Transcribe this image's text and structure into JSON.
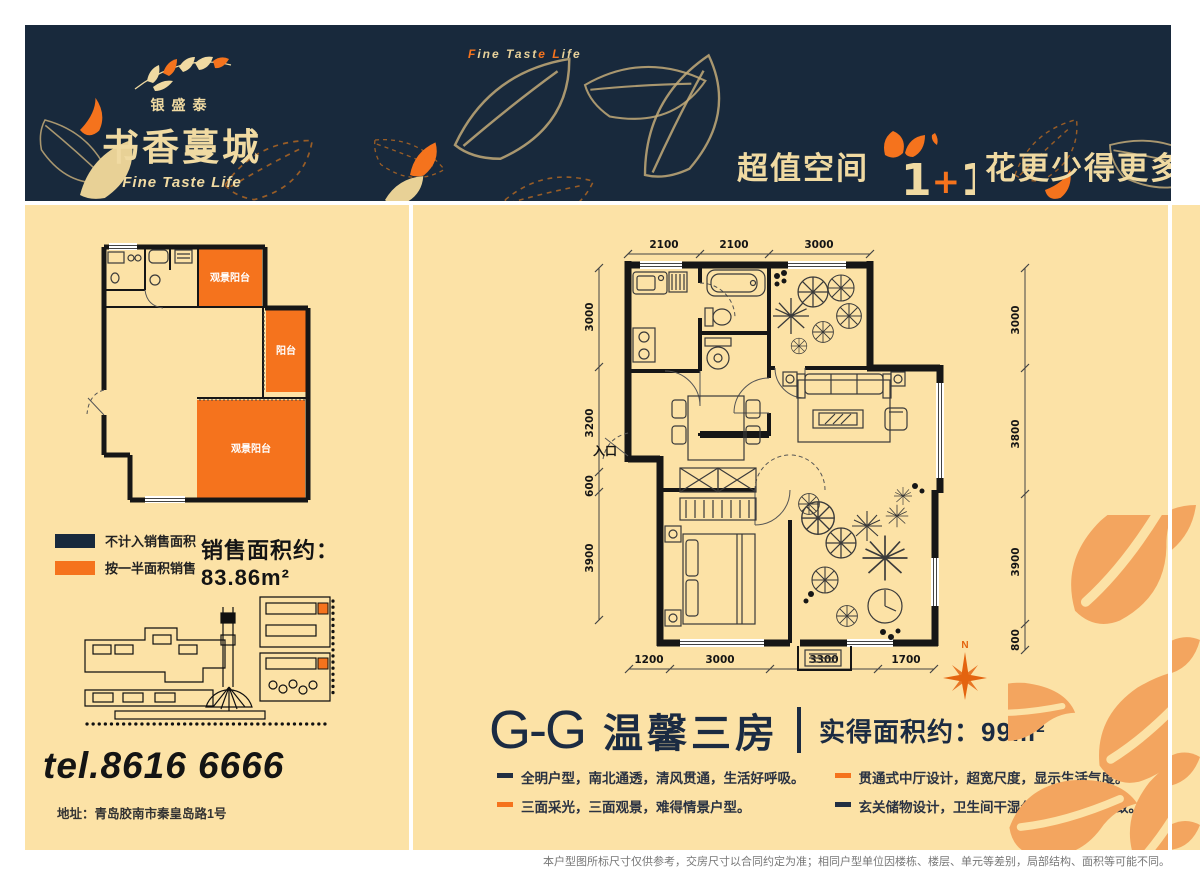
{
  "colors": {
    "navy": "#18293C",
    "cream": "#FCE2A6",
    "beige_text": "#F0DAA2",
    "orange": "#F5731D",
    "leaf_orange": "#F3A55F",
    "ink": "#161616"
  },
  "header": {
    "brand_small": "银盛泰",
    "brand_main": "书香蔓城",
    "brand_sub": "Fine Taste Life",
    "tagline_parts": [
      "F",
      "ine ",
      "Tast",
      "e ",
      "L",
      "ife"
    ],
    "promo_left": "超值空间",
    "promo_mark_parts": [
      "1",
      "+",
      "1"
    ],
    "promo_right": "花更少得更多"
  },
  "left_panel": {
    "plan_labels": {
      "balcony_top": "观景阳台",
      "balcony_side": "阳台",
      "balcony_bottom": "观景阳台"
    },
    "legend": [
      {
        "label": "不计入销售面积",
        "color": "#18293C"
      },
      {
        "label": "按一半面积销售",
        "color": "#F5731D"
      }
    ],
    "sales_area": "销售面积约：83.86m²",
    "tel": "tel.8616 6666",
    "address": "地址：青岛胶南市秦皇岛路1号"
  },
  "right_panel": {
    "plan": {
      "entrance_label": "入口",
      "compass_label": "N",
      "dims_top": [
        "2100",
        "2100",
        "3000"
      ],
      "dims_left": [
        "3000",
        "3200",
        "600",
        "3900"
      ],
      "dims_right": [
        "3000",
        "3800",
        "3900",
        "800"
      ],
      "dims_bottom": [
        "1200",
        "3000",
        "3300",
        "1700"
      ]
    },
    "title_code": "G-G",
    "title_name": "温馨三房",
    "title_area": "实得面积约：99m²",
    "features": [
      "全明户型，南北通透，清风贯通，生活好呼吸。",
      "三面采光，三面观景，难得情景户型。",
      "贯通式中厅设计，超宽尺度，显示生活气度。",
      "玄关储物设计，卫生间干湿分离，生活更精致。"
    ]
  },
  "footer": {
    "disclaimer": "本户型图所标尺寸仅供参考，交房尺寸以合同约定为准；相同户型单位因楼栋、楼层、单元等差别，局部结构、面积等可能不同。"
  }
}
